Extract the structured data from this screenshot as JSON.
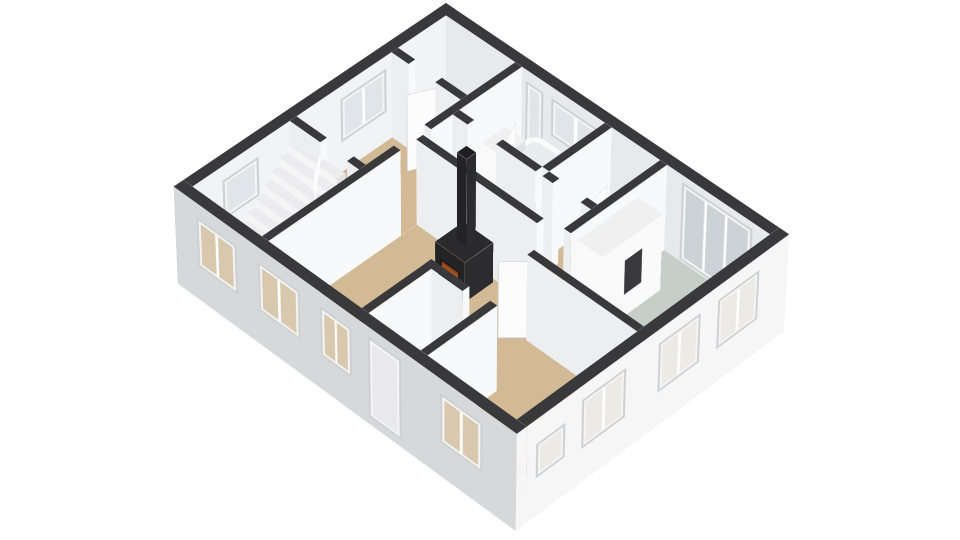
{
  "meta": {
    "title": "3d-floorplan-isometric-view",
    "description": "3D isometric floor plan rendering of a single storey, white background, dark wall caps"
  },
  "view": {
    "perspective": 6000,
    "perspective_origin_x": 448,
    "perspective_origin_y": 70,
    "plan_left": 446,
    "plan_top": 88,
    "rotate_x": 47,
    "rotate_z": 45,
    "scale": 0.92,
    "wall_height": 115,
    "ext_base_z": -16
  },
  "colors": {
    "background": "#ffffff",
    "wall_top": "#39393b",
    "int_face_sw": "#eceeef",
    "int_face_se": "#f8f9fa",
    "ext_sw_outer": "#d7d8da",
    "ext_se_outer": "#f6f6f7",
    "ext_ne_inner": "#e7e9ea",
    "ext_nw_inner": "#f2f3f4",
    "floor_tan": "#d3ba97",
    "floor_blue": "#a9c3d8",
    "floor_orange": "#dfa552",
    "floor_sage": "#c6cfc7",
    "frame": "#f4f4f5",
    "frame_border": "#cfd0d2",
    "glass_sw": "#d8c9ae",
    "glass_se": "#eceae4",
    "glass_ne": "#dfe5e9",
    "glass_french": "#ccd3d7",
    "door_panel_outer": "#e9e9eb",
    "door_panel": "#fcfcfd",
    "door_panel_border": "#d5d5d7",
    "step_top": "#ececee",
    "step_riser": "#f5f5f6",
    "step_side": "#e2e2e4",
    "stove_body": "#232325",
    "stove_top": "#2a2a2c",
    "stove_side": "#2c2c2e",
    "chimney_top": "#1f1f21",
    "fire_glow_a": "#d27b2e",
    "fire_glow_b": "#8a3c14",
    "tub_top": "#fafbfb",
    "tub_basin": "#e8eef0",
    "tub_side": "#fdfdfe",
    "furniture_white_top": "#f0f0f1",
    "furniture_white_side": "#fafafb",
    "niche_dark": "#3a3a3c"
  },
  "floors": [
    {
      "name": "floor-closet",
      "rect": [
        14,
        14,
        118,
        96
      ],
      "color_key": "floor_tan",
      "room": "closet"
    },
    {
      "name": "floor-bedroom-1",
      "rect": [
        14,
        86,
        128,
        246
      ],
      "color_key": "floor_tan",
      "room": "bedroom-1"
    },
    {
      "name": "floor-stair-room",
      "rect": [
        14,
        236,
        128,
        386
      ],
      "color_key": "floor_tan",
      "room": "stair-room"
    },
    {
      "name": "floor-bathroom",
      "rect": [
        128,
        14,
        250,
        113
      ],
      "color_key": "floor_blue",
      "room": "bathroom"
    },
    {
      "name": "floor-wc",
      "rect": [
        260,
        14,
        330,
        113
      ],
      "color_key": "floor_tan",
      "room": "wc"
    },
    {
      "name": "floor-hallway",
      "rect": [
        128,
        113,
        335,
        162
      ],
      "color_key": "floor_orange",
      "room": "hallway"
    },
    {
      "name": "floor-green-bedroom",
      "rect": [
        335,
        14,
        486,
        207
      ],
      "color_key": "floor_sage",
      "room": "green-bedroom"
    },
    {
      "name": "floor-living-room-a",
      "rect": [
        128,
        162,
        362,
        386
      ],
      "color_key": "floor_tan",
      "room": "living-room"
    },
    {
      "name": "floor-living-room-b",
      "rect": [
        340,
        211,
        486,
        386
      ],
      "color_key": "floor_tan",
      "room": "living-room"
    }
  ],
  "exterior_walls": [
    {
      "name": "wall-ne",
      "rect": [
        0,
        0,
        486,
        14
      ],
      "py_key": "ext_ne_inner",
      "px_key": "ext_se_outer",
      "register_py": "ne_inner"
    },
    {
      "name": "wall-nw",
      "rect": [
        0,
        0,
        14,
        386
      ],
      "py_key": "int_face_sw",
      "px_key": "ext_nw_inner",
      "register_px": "nw_inner"
    },
    {
      "name": "wall-sw",
      "rect": [
        0,
        386,
        500,
        400
      ],
      "py_key": "ext_sw_outer",
      "px_key": "ext_se_outer",
      "register_py": "sw_outer"
    },
    {
      "name": "wall-se",
      "rect": [
        486,
        0,
        500,
        386
      ],
      "py_key": "int_face_sw",
      "px_key": "ext_se_outer",
      "register_px": "se_outer"
    }
  ],
  "interior_walls": [
    {
      "name": "wall-closet-a",
      "rect": [
        14,
        86,
        40,
        96
      ]
    },
    {
      "name": "wall-closet-b",
      "rect": [
        80,
        86,
        118,
        96
      ]
    },
    {
      "name": "wall-bedroom-stair-a",
      "rect": [
        14,
        236,
        60,
        246
      ]
    },
    {
      "name": "wall-bedroom-stair-b",
      "rect": [
        100,
        236,
        118,
        246
      ]
    },
    {
      "name": "wall-left-column-upper",
      "rect": [
        118,
        14,
        128,
        150
      ]
    },
    {
      "name": "wall-left-column-lower",
      "rect": [
        118,
        195,
        128,
        386
      ]
    },
    {
      "name": "wall-bath-wc",
      "rect": [
        250,
        14,
        260,
        108
      ]
    },
    {
      "name": "wall-hall-south",
      "rect": [
        128,
        162,
        305,
        172
      ]
    },
    {
      "name": "wall-green-left",
      "rect": [
        330,
        14,
        340,
        158
      ]
    },
    {
      "name": "wall-green-bottom",
      "rect": [
        330,
        202,
        486,
        212
      ]
    },
    {
      "name": "wall-bath-hall-a",
      "rect": [
        128,
        108,
        150,
        118
      ]
    },
    {
      "name": "wall-bath-hall-b",
      "rect": [
        192,
        108,
        250,
        118
      ]
    },
    {
      "name": "wall-wc-hall-a",
      "rect": [
        260,
        108,
        275,
        118
      ]
    },
    {
      "name": "wall-wc-hall-b",
      "rect": [
        315,
        108,
        330,
        118
      ]
    },
    {
      "name": "wall-vestibule-left",
      "rect": [
        265,
        286,
        275,
        386
      ]
    },
    {
      "name": "wall-vestibule-right",
      "rect": [
        350,
        286,
        360,
        386
      ]
    },
    {
      "name": "wall-vestibule-top",
      "rect": [
        265,
        286,
        320,
        296
      ]
    }
  ],
  "windows": [
    {
      "name": "window-stair-room-sw",
      "on": "sw_outer",
      "left": 34,
      "w": 60,
      "z": [
        30,
        96
      ],
      "kind": "win",
      "glass_key": "glass_sw"
    },
    {
      "name": "window-living-sw-1",
      "on": "sw_outer",
      "left": 126,
      "w": 62,
      "z": [
        30,
        96
      ],
      "kind": "win",
      "glass_key": "glass_sw"
    },
    {
      "name": "window-living-sw-2",
      "on": "sw_outer",
      "left": 218,
      "w": 46,
      "z": [
        30,
        96
      ],
      "kind": "win",
      "glass_key": "glass_sw"
    },
    {
      "name": "front-door",
      "on": "sw_outer",
      "left": 288,
      "w": 48,
      "z": [
        -6,
        102
      ],
      "kind": "door",
      "glass_key": "glass_sw"
    },
    {
      "name": "window-living-sw-3",
      "on": "sw_outer",
      "left": 392,
      "w": 60,
      "z": [
        30,
        96
      ],
      "kind": "win",
      "glass_key": "glass_sw"
    },
    {
      "name": "window-green-se-1",
      "on": "se_outer",
      "left": 44,
      "w": 62,
      "z": [
        30,
        96
      ],
      "kind": "win",
      "glass_key": "glass_se"
    },
    {
      "name": "window-green-se-2",
      "on": "se_outer",
      "left": 132,
      "w": 62,
      "z": [
        30,
        96
      ],
      "kind": "win",
      "glass_key": "glass_se"
    },
    {
      "name": "window-living-se",
      "on": "se_outer",
      "left": 242,
      "w": 64,
      "z": [
        30,
        96
      ],
      "kind": "win",
      "glass_key": "glass_se"
    },
    {
      "name": "window-small-se",
      "on": "se_outer",
      "left": 330,
      "w": 42,
      "z": [
        36,
        82
      ],
      "kind": "small",
      "glass_key": "glass_se"
    },
    {
      "name": "window-bathroom-tall",
      "on": "ne_inner",
      "left": 134,
      "w": 26,
      "z": [
        10,
        100
      ],
      "kind": "tall",
      "glass_key": "glass_ne"
    },
    {
      "name": "window-bathroom-tub",
      "on": "ne_inner",
      "left": 172,
      "w": 72,
      "z": [
        50,
        100
      ],
      "kind": "win",
      "glass_key": "glass_ne"
    },
    {
      "name": "french-doors-green-bedroom",
      "on": "ne_inner",
      "left": 362,
      "w": 100,
      "z": [
        2,
        106
      ],
      "kind": "french",
      "glass_key": "glass_french"
    },
    {
      "name": "window-bedroom-1-nw",
      "on": "nw_inner",
      "left": 104,
      "w": 68,
      "z": [
        40,
        98
      ],
      "kind": "win",
      "glass_key": "glass_ne"
    },
    {
      "name": "window-stair-nw",
      "on": "nw_inner",
      "left": 292,
      "w": 52,
      "z": [
        44,
        96
      ],
      "kind": "small",
      "glass_key": "glass_ne"
    }
  ],
  "door_panels": [
    {
      "name": "door-closet-open",
      "hinge": [
        80,
        86
      ],
      "rot": 115,
      "w": 38
    },
    {
      "name": "door-bedroom-stair-open",
      "hinge": [
        60,
        246
      ],
      "rot": 55,
      "w": 38
    },
    {
      "name": "door-bathroom-open",
      "hinge": [
        192,
        108
      ],
      "rot": -115,
      "w": 40
    },
    {
      "name": "door-wc-open",
      "hinge": [
        315,
        108
      ],
      "rot": -100,
      "w": 36
    },
    {
      "name": "door-green-bedroom-open",
      "hinge": [
        338,
        200
      ],
      "rot": 135,
      "w": 42
    }
  ],
  "furniture": {
    "stove": {
      "name": "wood-stove",
      "rect": [
        202,
        176,
        246,
        218
      ],
      "h": 54
    },
    "chimney": {
      "name": "stove-chimney-pipe",
      "rect": [
        216,
        186,
        230,
        200
      ],
      "z0": 54,
      "z1": 170
    },
    "bathtub": {
      "name": "bathtub",
      "rect": [
        150,
        16,
        242,
        58
      ],
      "h": 40
    },
    "sink": {
      "name": "bathroom-sink",
      "rect": [
        130,
        40,
        160,
        76
      ],
      "h": 52
    },
    "wardrobe": {
      "name": "wardrobe-green-bedroom",
      "rect": [
        342,
        60,
        378,
        150
      ],
      "h": 102,
      "niche": {
        "left": 30,
        "top": 30,
        "w": 26,
        "h": 46
      }
    },
    "stairs": {
      "name": "staircase",
      "x0": 16,
      "x1": 92,
      "y_start": 336,
      "depth": 12,
      "count": 8,
      "h0": 12,
      "dh": 11
    }
  }
}
